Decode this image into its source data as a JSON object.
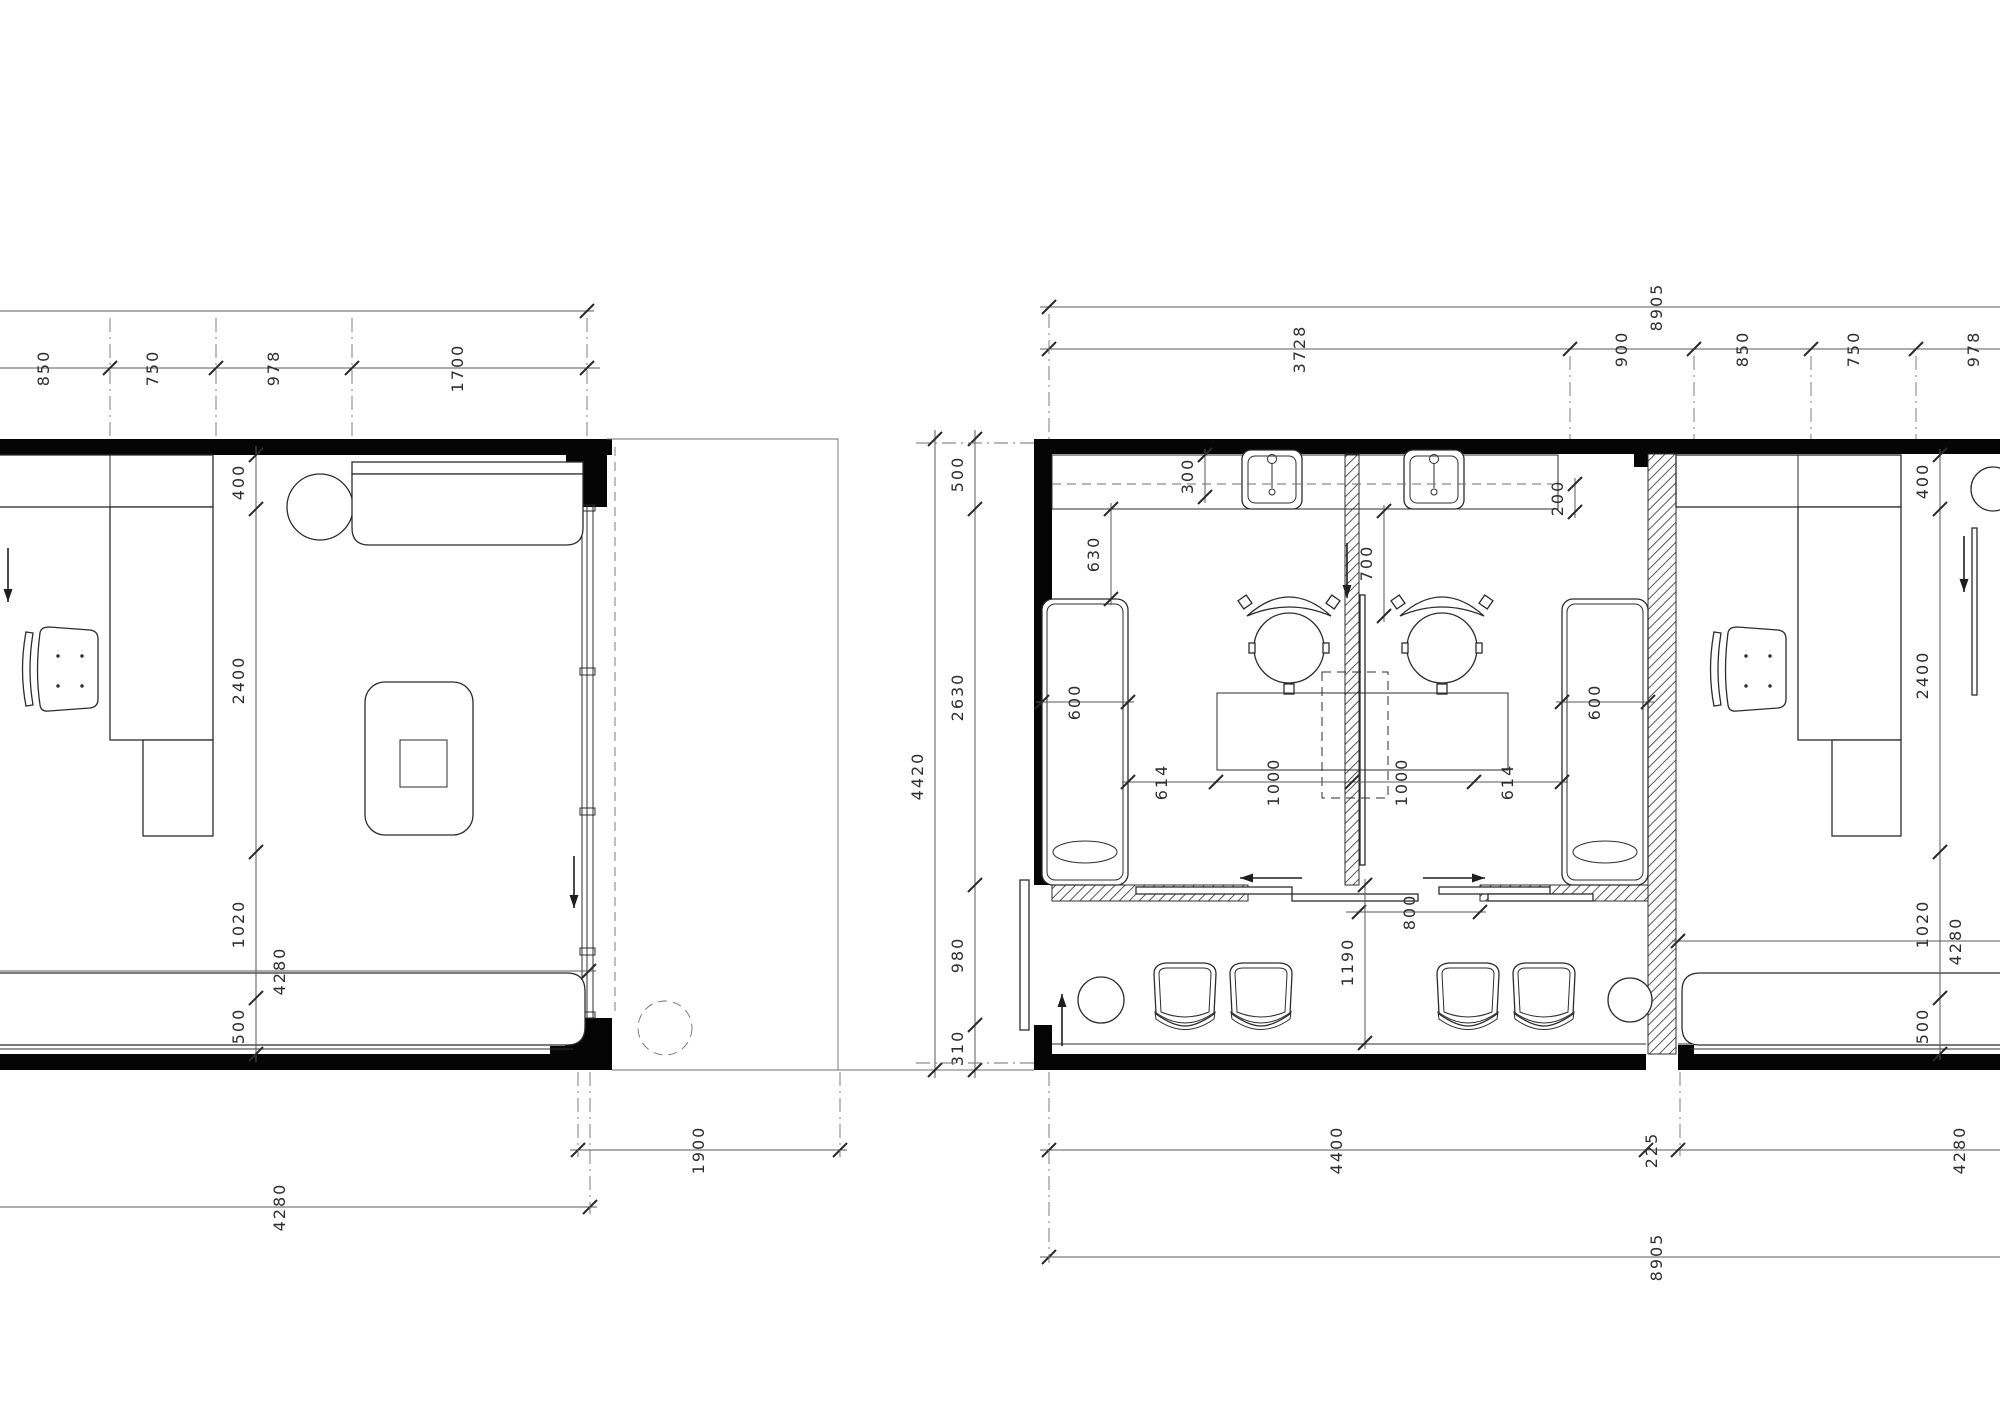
{
  "drawing": {
    "title": "spa-treatment-rooms-floor-plan",
    "units": "mm",
    "colors": {
      "line": "#2c2c2c",
      "wall_fill": "#050505",
      "dim_text": "#2e2e2e",
      "background": "#ffffff"
    },
    "plans": [
      {
        "id": "plan-left",
        "name": "office-room-detail-plan"
      },
      {
        "id": "plan-right",
        "name": "treatment-rooms-plan"
      }
    ]
  },
  "dim_lines": [
    {
      "name": "left-top-outer",
      "dir": "h",
      "pos": 311,
      "from": -12,
      "to": 594,
      "ticks": [
        587
      ],
      "labels": []
    },
    {
      "name": "left-top-chain",
      "dir": "h",
      "pos": 368,
      "from": -12,
      "to": 600,
      "ticks": [
        110,
        216,
        352,
        587
      ],
      "labels": [
        {
          "text": "850",
          "at": 54
        },
        {
          "text": "750",
          "at": 163
        },
        {
          "text": "978",
          "at": 284
        },
        {
          "text": "1700",
          "at": 468
        }
      ]
    },
    {
      "name": "left-room-chain",
      "dir": "v",
      "pos": 256,
      "from": 446,
      "to": 1062,
      "ticks": [
        455,
        509,
        852,
        998,
        1054
      ],
      "labels": [
        {
          "text": "400",
          "at": 482
        },
        {
          "text": "2400",
          "at": 680
        },
        {
          "text": "1020",
          "at": 924
        },
        {
          "text": "500",
          "at": 1026
        }
      ]
    },
    {
      "name": "left-room-width",
      "dir": "h",
      "pos": 971,
      "from": -12,
      "to": 596,
      "ticks": [
        589
      ],
      "labels": [
        {
          "text": "4280",
          "at": 290
        }
      ]
    },
    {
      "name": "left-bottom-1900",
      "dir": "h",
      "pos": 1150,
      "from": 570,
      "to": 847,
      "ticks": [
        578,
        840
      ],
      "labels": [
        {
          "text": "1900",
          "at": 709
        }
      ]
    },
    {
      "name": "left-bottom-4280",
      "dir": "h",
      "pos": 1207,
      "from": -12,
      "to": 597,
      "ticks": [
        590
      ],
      "labels": [
        {
          "text": "4280",
          "at": 290
        }
      ]
    },
    {
      "name": "right-top-outer",
      "dir": "h",
      "pos": 307,
      "from": 1040,
      "to": 2000,
      "ticks": [
        1049
      ],
      "labels": [
        {
          "text": "8905",
          "at": 1667
        }
      ]
    },
    {
      "name": "right-top-chain",
      "dir": "h",
      "pos": 349,
      "from": 1040,
      "to": 2000,
      "ticks": [
        1049,
        1570,
        1694,
        1811,
        1916
      ],
      "labels": [
        {
          "text": "3728",
          "at": 1310
        },
        {
          "text": "900",
          "at": 1632
        },
        {
          "text": "850",
          "at": 1753
        },
        {
          "text": "750",
          "at": 1864
        },
        {
          "text": "978",
          "at": 1984
        }
      ]
    },
    {
      "name": "right-left-outer",
      "dir": "v",
      "pos": 935,
      "from": 430,
      "to": 1078,
      "ticks": [
        439,
        1070
      ],
      "labels": [
        {
          "text": "4420",
          "at": 776
        }
      ]
    },
    {
      "name": "right-left-chain",
      "dir": "v",
      "pos": 975,
      "from": 430,
      "to": 1078,
      "ticks": [
        439,
        509,
        885,
        1025,
        1070
      ],
      "labels": [
        {
          "text": "500",
          "at": 474
        },
        {
          "text": "2630",
          "at": 697
        },
        {
          "text": "980",
          "at": 955
        },
        {
          "text": "310",
          "at": 1048
        }
      ]
    },
    {
      "name": "right-counter-300",
      "dir": "v",
      "pos": 1205,
      "from": 449,
      "to": 503,
      "ticks": [
        455,
        497
      ],
      "labels": [
        {
          "text": "300",
          "at": 476
        }
      ]
    },
    {
      "name": "right-counter-200",
      "dir": "v",
      "pos": 1575,
      "from": 478,
      "to": 518,
      "ticks": [
        484,
        512
      ],
      "labels": [
        {
          "text": "200",
          "at": 498
        }
      ]
    },
    {
      "name": "right-screen-700",
      "dir": "v",
      "pos": 1384,
      "from": 505,
      "to": 622,
      "ticks": [
        511,
        616
      ],
      "labels": [
        {
          "text": "700",
          "at": 563
        }
      ]
    },
    {
      "name": "right-lounger-630",
      "dir": "v",
      "pos": 1111,
      "from": 503,
      "to": 605,
      "ticks": [
        509,
        599
      ],
      "labels": [
        {
          "text": "630",
          "at": 554
        }
      ]
    },
    {
      "name": "left-lounger-600",
      "dir": "h",
      "pos": 702,
      "from": 1036,
      "to": 1134,
      "ticks": [
        1042,
        1128
      ],
      "labels": [
        {
          "text": "600",
          "at": 1085
        }
      ]
    },
    {
      "name": "right-lounger-600",
      "dir": "h",
      "pos": 702,
      "from": 1556,
      "to": 1654,
      "ticks": [
        1562,
        1648
      ],
      "labels": [
        {
          "text": "600",
          "at": 1605
        }
      ]
    },
    {
      "name": "stations-row",
      "dir": "h",
      "pos": 782,
      "from": 1122,
      "to": 1568,
      "ticks": [
        1128,
        1216,
        1352,
        1474,
        1562
      ],
      "labels": [
        {
          "text": "614",
          "at": 1172
        },
        {
          "text": "1000",
          "at": 1284
        },
        {
          "text": "1000",
          "at": 1412
        },
        {
          "text": "614",
          "at": 1518
        }
      ]
    },
    {
      "name": "door-800",
      "dir": "h",
      "pos": 912,
      "from": 1346,
      "to": 1486,
      "ticks": [
        1359,
        1480
      ],
      "labels": [
        {
          "text": "800",
          "at": 1420
        }
      ]
    },
    {
      "name": "partition-1190",
      "dir": "v",
      "pos": 1365,
      "from": 879,
      "to": 1049,
      "ticks": [
        885,
        1043
      ],
      "labels": [
        {
          "text": "1190",
          "at": 962
        }
      ]
    },
    {
      "name": "right-office-chain",
      "dir": "v",
      "pos": 1940,
      "from": 449,
      "to": 1060,
      "ticks": [
        455,
        509,
        852,
        998,
        1054
      ],
      "labels": [
        {
          "text": "400",
          "at": 481
        },
        {
          "text": "2400",
          "at": 675
        },
        {
          "text": "1020",
          "at": 924
        },
        {
          "text": "500",
          "at": 1026
        }
      ]
    },
    {
      "name": "right-office-width",
      "dir": "h",
      "pos": 941,
      "from": 1672,
      "to": 2000,
      "ticks": [
        1678
      ],
      "labels": [
        {
          "text": "4280",
          "at": 1966
        }
      ]
    },
    {
      "name": "right-bottom-chain",
      "dir": "h",
      "pos": 1150,
      "from": 1040,
      "to": 2000,
      "ticks": [
        1049,
        1646,
        1678
      ],
      "labels": [
        {
          "text": "4400",
          "at": 1347
        },
        {
          "text": "225",
          "at": 1662
        },
        {
          "text": "4280",
          "at": 1970
        }
      ]
    },
    {
      "name": "right-bottom-outer",
      "dir": "h",
      "pos": 1257,
      "from": 1040,
      "to": 2000,
      "ticks": [
        1049
      ],
      "labels": [
        {
          "text": "8905",
          "at": 1667
        }
      ]
    }
  ],
  "ext_lines": [
    {
      "name": "left-top-grid-1",
      "x1": 110,
      "y1": 318,
      "x2": 110,
      "y2": 439,
      "style": "dashdot"
    },
    {
      "name": "left-top-grid-2",
      "x1": 216,
      "y1": 318,
      "x2": 216,
      "y2": 439,
      "style": "dashdot"
    },
    {
      "name": "left-top-grid-3",
      "x1": 352,
      "y1": 318,
      "x2": 352,
      "y2": 439,
      "style": "dashdot"
    },
    {
      "name": "left-top-grid-4",
      "x1": 587,
      "y1": 318,
      "x2": 587,
      "y2": 439,
      "style": "dashdot"
    },
    {
      "name": "left-bottom-grid-1",
      "x1": 578,
      "y1": 1072,
      "x2": 578,
      "y2": 1157,
      "style": "dashdot"
    },
    {
      "name": "left-bottom-grid-2",
      "x1": 840,
      "y1": 1072,
      "x2": 840,
      "y2": 1157,
      "style": "dashdot"
    },
    {
      "name": "left-bottom-grid-3",
      "x1": 590,
      "y1": 1072,
      "x2": 590,
      "y2": 1214,
      "style": "dashdot"
    },
    {
      "name": "left-terrace-dashed",
      "x1": 615,
      "y1": 447,
      "x2": 615,
      "y2": 1014,
      "style": "dashed"
    },
    {
      "name": "right-top-grid-1",
      "x1": 1049,
      "y1": 314,
      "x2": 1049,
      "y2": 439,
      "style": "dashdot"
    },
    {
      "name": "right-top-grid-2",
      "x1": 1570,
      "y1": 356,
      "x2": 1570,
      "y2": 439,
      "style": "dashdot"
    },
    {
      "name": "right-top-grid-3",
      "x1": 1694,
      "y1": 356,
      "x2": 1694,
      "y2": 439,
      "style": "dashdot"
    },
    {
      "name": "right-top-grid-4",
      "x1": 1811,
      "y1": 356,
      "x2": 1811,
      "y2": 439,
      "style": "dashdot"
    },
    {
      "name": "right-top-grid-5",
      "x1": 1916,
      "y1": 356,
      "x2": 1916,
      "y2": 439,
      "style": "dashdot"
    },
    {
      "name": "right-left-grid-top",
      "x1": 916,
      "y1": 443,
      "x2": 1034,
      "y2": 443,
      "style": "dashdot"
    },
    {
      "name": "right-left-grid-bottom",
      "x1": 916,
      "y1": 1063,
      "x2": 1034,
      "y2": 1063,
      "style": "dashdot"
    },
    {
      "name": "right-bottom-grid-1",
      "x1": 1049,
      "y1": 1072,
      "x2": 1049,
      "y2": 1263,
      "style": "dashdot"
    },
    {
      "name": "right-bottom-grid-2",
      "x1": 1680,
      "y1": 1072,
      "x2": 1680,
      "y2": 1156,
      "style": "dashdot"
    },
    {
      "name": "counter-dashed-line",
      "x1": 1052,
      "y1": 484,
      "x2": 1558,
      "y2": 484,
      "style": "dashed"
    }
  ],
  "arrows": [
    {
      "name": "left-office-entry-arrow",
      "x1": 8,
      "y1": 548,
      "x2": 8,
      "y2": 602
    },
    {
      "name": "left-office-window-arrow",
      "x1": 574,
      "y1": 856,
      "x2": 574,
      "y2": 908
    },
    {
      "name": "partition-screen-arrow",
      "x1": 1347,
      "y1": 543,
      "x2": 1347,
      "y2": 598
    },
    {
      "name": "right-office-entry-arrow",
      "x1": 1964,
      "y1": 536,
      "x2": 1964,
      "y2": 592
    },
    {
      "name": "left-room-door-slide-arrow",
      "x1": 1302,
      "y1": 878,
      "x2": 1240,
      "y2": 878
    },
    {
      "name": "right-room-door-slide-arrow",
      "x1": 1423,
      "y1": 878,
      "x2": 1485,
      "y2": 878
    },
    {
      "name": "entry-door-slide-arrow",
      "x1": 1062,
      "y1": 1046,
      "x2": 1062,
      "y2": 994
    }
  ]
}
